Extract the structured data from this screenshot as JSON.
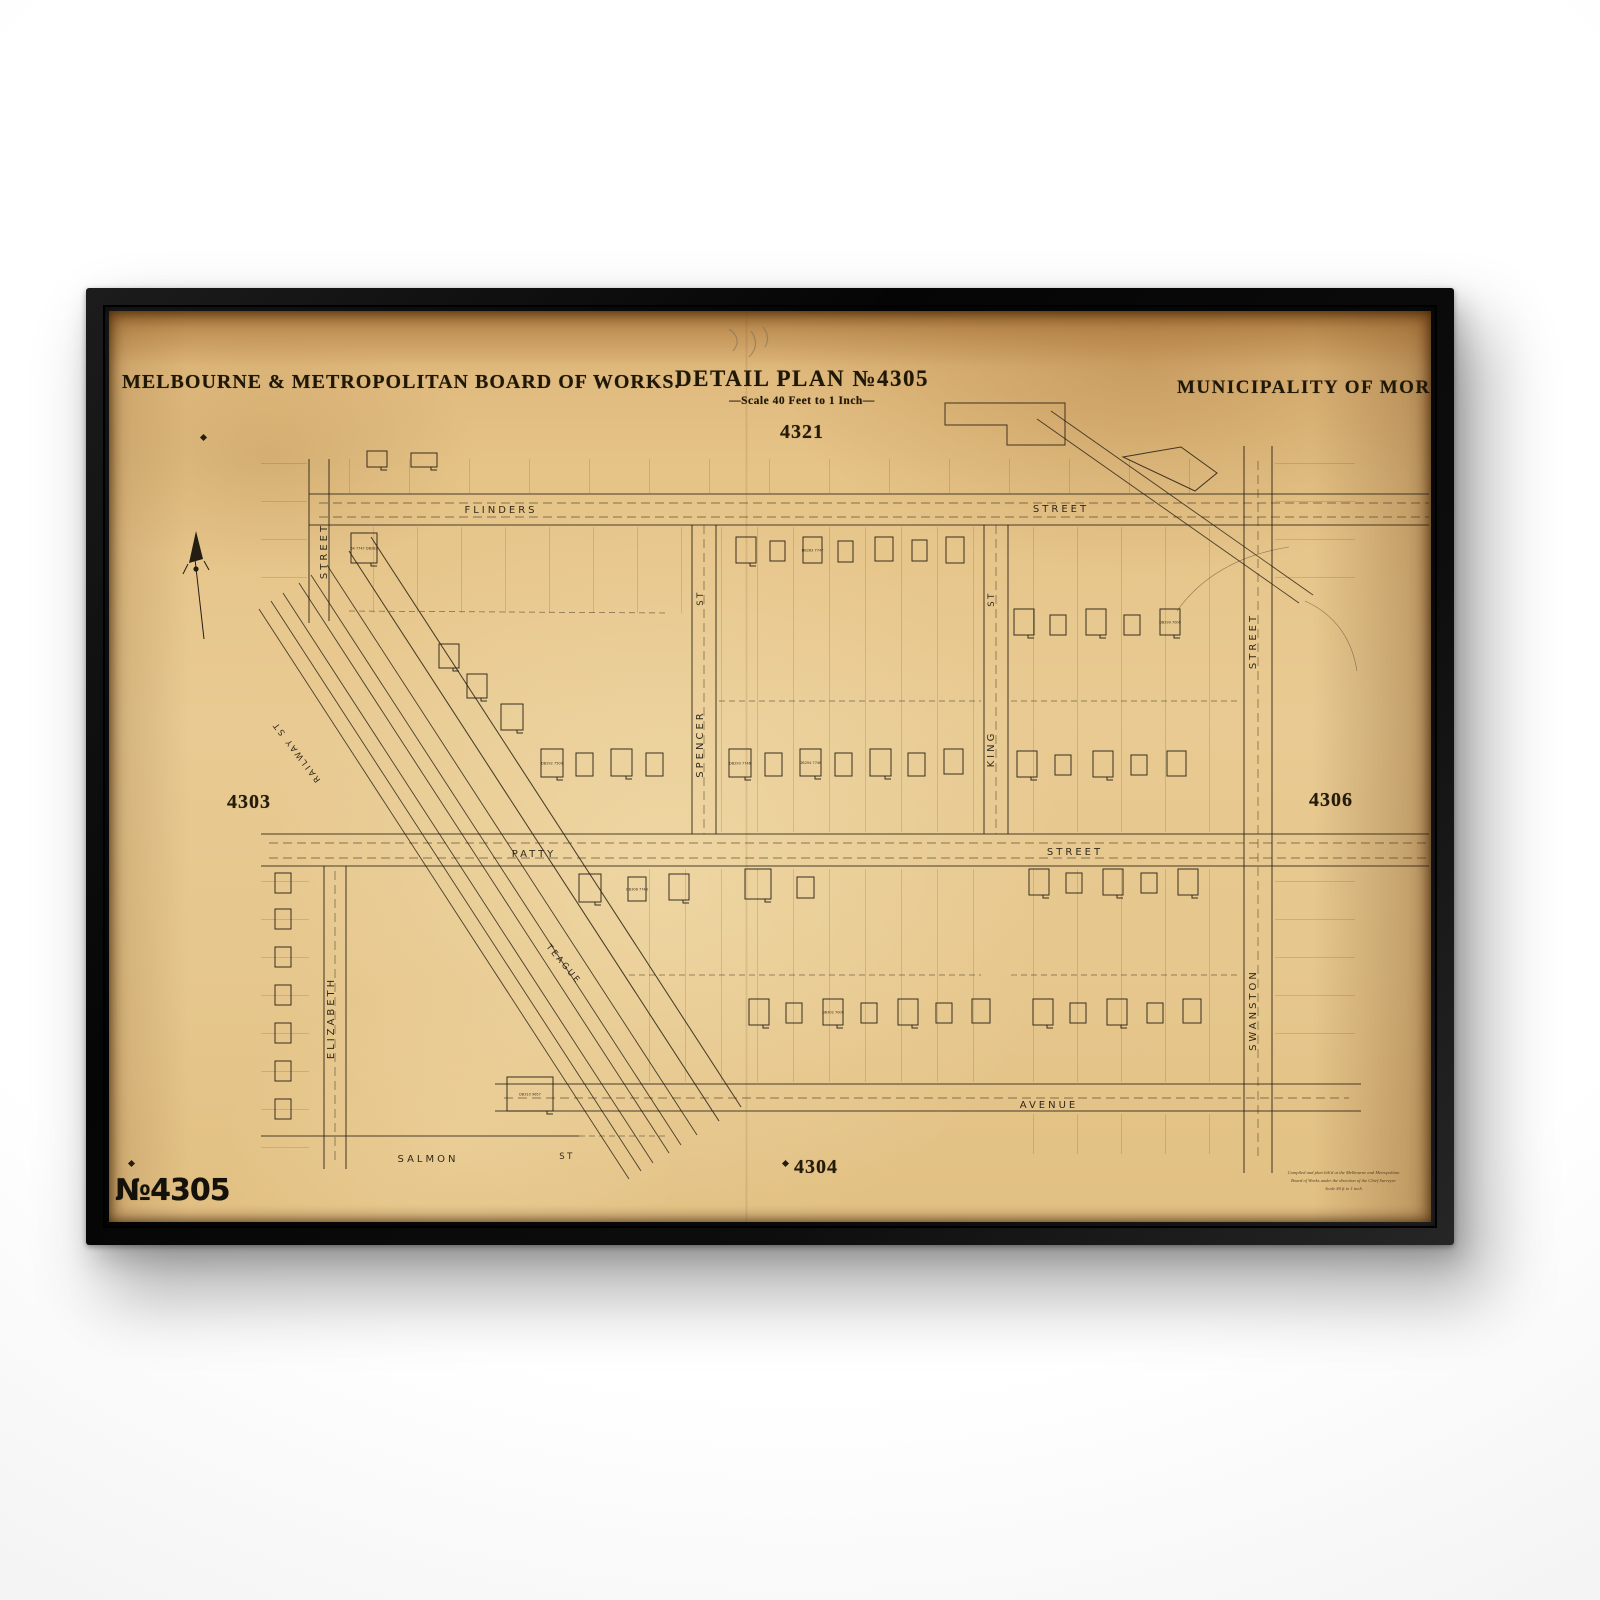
{
  "header": {
    "publisher": "MELBOURNE & METROPOLITAN BOARD OF WORKS.",
    "plan_title": "DETAIL PLAN №4305",
    "scale_note": "—Scale 40 Feet to 1 Inch—",
    "municipality": "MUNICIPALITY OF MORDIAL"
  },
  "sheet": {
    "number_label": "№4305",
    "adjacent_plan_top": "4321",
    "adjacent_plan_left": "4303",
    "adjacent_plan_right": "4306",
    "adjacent_plan_bottom": "4304"
  },
  "streets": {
    "flinders": "FLINDERS",
    "flinders_suffix": "STREET",
    "left_street": "STREET",
    "spencer_abbr": "ST",
    "spencer": "SPENCER",
    "king_abbr": "ST",
    "king": "KING",
    "right_street": "STREET",
    "swanston": "SWANSTON",
    "patty": "PATTY",
    "patty_suffix": "STREET",
    "elizabeth": "ELIZABETH",
    "teague": "TEAGUE",
    "railway": "RAILWAY ST",
    "salmon": "SALMON",
    "salmon_abbr": "ST",
    "avenue": "AVENUE"
  },
  "lot_labels": [
    "64 7747 DB282",
    "DB292 7500",
    "DB293 7746",
    "DB299 7000",
    "DB294 7746",
    "DB283 7747",
    "DB308 7748",
    "DB302 7000",
    "DB310 9657"
  ],
  "imprint": {
    "line1": "Compiled and plan lith'd at the Melbourne and Metropolitan",
    "line2": "Board of Works under the direction of the Chief Surveyor",
    "line3": "Scale 40 ft to 1 inch"
  },
  "colors": {
    "paper": "#e3c287",
    "ink": "#2b2318",
    "frame": "#0c0c0c"
  }
}
